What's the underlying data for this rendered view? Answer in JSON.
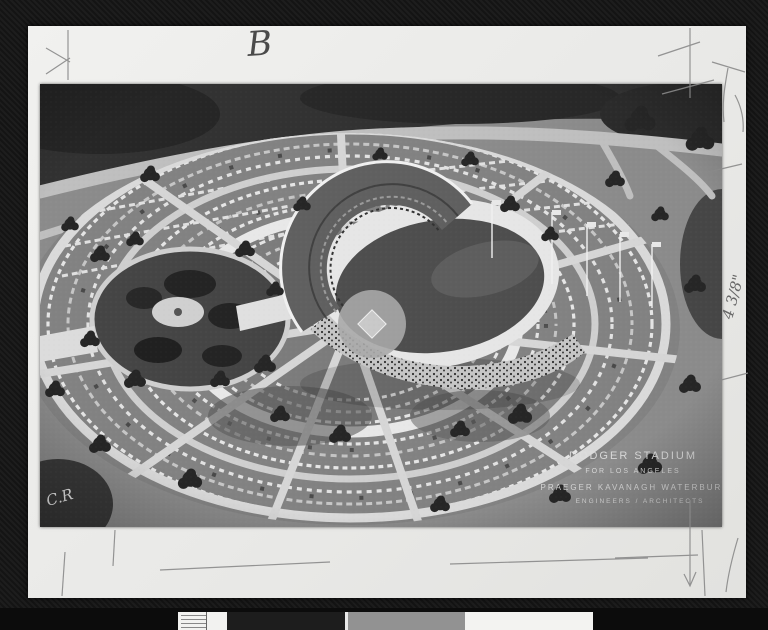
{
  "scan": {
    "top_label": "B",
    "size_note": "4 3/8\"",
    "photo_initials": "C.R",
    "caption": {
      "line1": "DODGER STADIUM",
      "line2": "FOR LOS ANGELES",
      "line3": "PRAEGER KAVANAGH WATERBURY",
      "line4": "ENGINEERS / ARCHITECTS"
    }
  },
  "colors": {
    "background": "#141414",
    "board": "#ededeb",
    "photo_midtone": "#8b8b8b",
    "roads": "#d8d8d8",
    "trees": "#262626",
    "stadium_rim": "#e6e6e6",
    "field": "#4e4e4e",
    "pencil": "#8a8a8a"
  }
}
